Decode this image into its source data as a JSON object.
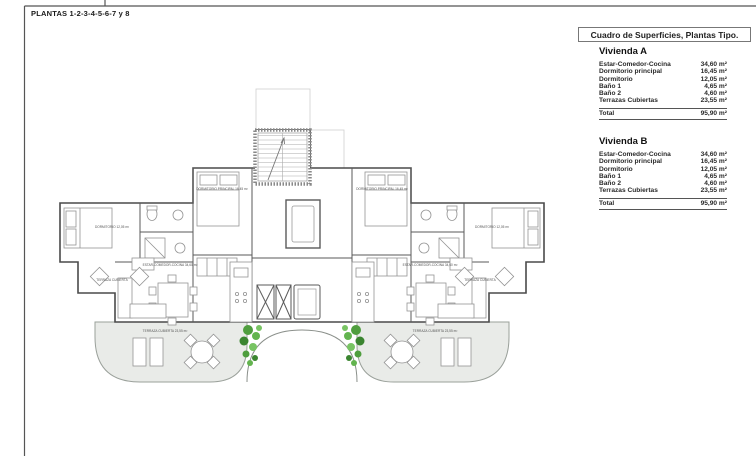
{
  "sheet": {
    "title": "PLANTAS 1-2-3-4-5-6-7 y 8"
  },
  "panel": {
    "title": "Cuadro de Superficies, Plantas Tipo.",
    "viviendas": [
      {
        "name": "Vivienda A",
        "rows": [
          {
            "label": "Estar-Comedor-Cocina",
            "value": "34,60 m²"
          },
          {
            "label": "Dormitorio principal",
            "value": "16,45 m²"
          },
          {
            "label": "Dormitorio",
            "value": "12,05 m²"
          },
          {
            "label": "Baño 1",
            "value": "4,65 m²"
          },
          {
            "label": "Baño 2",
            "value": "4,60 m²"
          },
          {
            "label": "Terrazas Cubiertas",
            "value": "23,55 m²"
          }
        ],
        "total_label": "Total",
        "total_value": "95,90 m²"
      },
      {
        "name": "Vivienda B",
        "rows": [
          {
            "label": "Estar-Comedor-Cocina",
            "value": "34,60 m²"
          },
          {
            "label": "Dormitorio principal",
            "value": "16,45 m²"
          },
          {
            "label": "Dormitorio",
            "value": "12,05 m²"
          },
          {
            "label": "Baño 1",
            "value": "4,65 m²"
          },
          {
            "label": "Baño 2",
            "value": "4,60 m²"
          },
          {
            "label": "Terrazas Cubiertas",
            "value": "23,55 m²"
          }
        ],
        "total_label": "Total",
        "total_value": "95,90 m²"
      }
    ]
  },
  "plan": {
    "labels": [
      {
        "text": "DORMITORIO PRINCIPAL 16,45 m²"
      },
      {
        "text": "DORMITORIO PRINCIPAL 16,45 m²"
      },
      {
        "text": "DORMITORIO 12,05 m²"
      },
      {
        "text": "DORMITORIO 12,05 m²"
      },
      {
        "text": "TERRAZA CUBIERTA"
      },
      {
        "text": "TERRAZA CUBIERTA"
      },
      {
        "text": "ESTAR-COMEDOR-COCINA 34,60 m²"
      },
      {
        "text": "ESTAR-COMEDOR-COCINA 34,60 m²"
      },
      {
        "text": "TERRAZA CUBIERTA 23,55 m²"
      },
      {
        "text": "TERRAZA CUBIERTA 23,55 m²"
      }
    ]
  },
  "colors": {
    "wall_line": "#4a4a4a",
    "terrace_fill": "#e9ebe8",
    "plant_green": "#4f9e3e",
    "sky_blue": "#82a4c6",
    "pool_blue": "#76aac7"
  }
}
